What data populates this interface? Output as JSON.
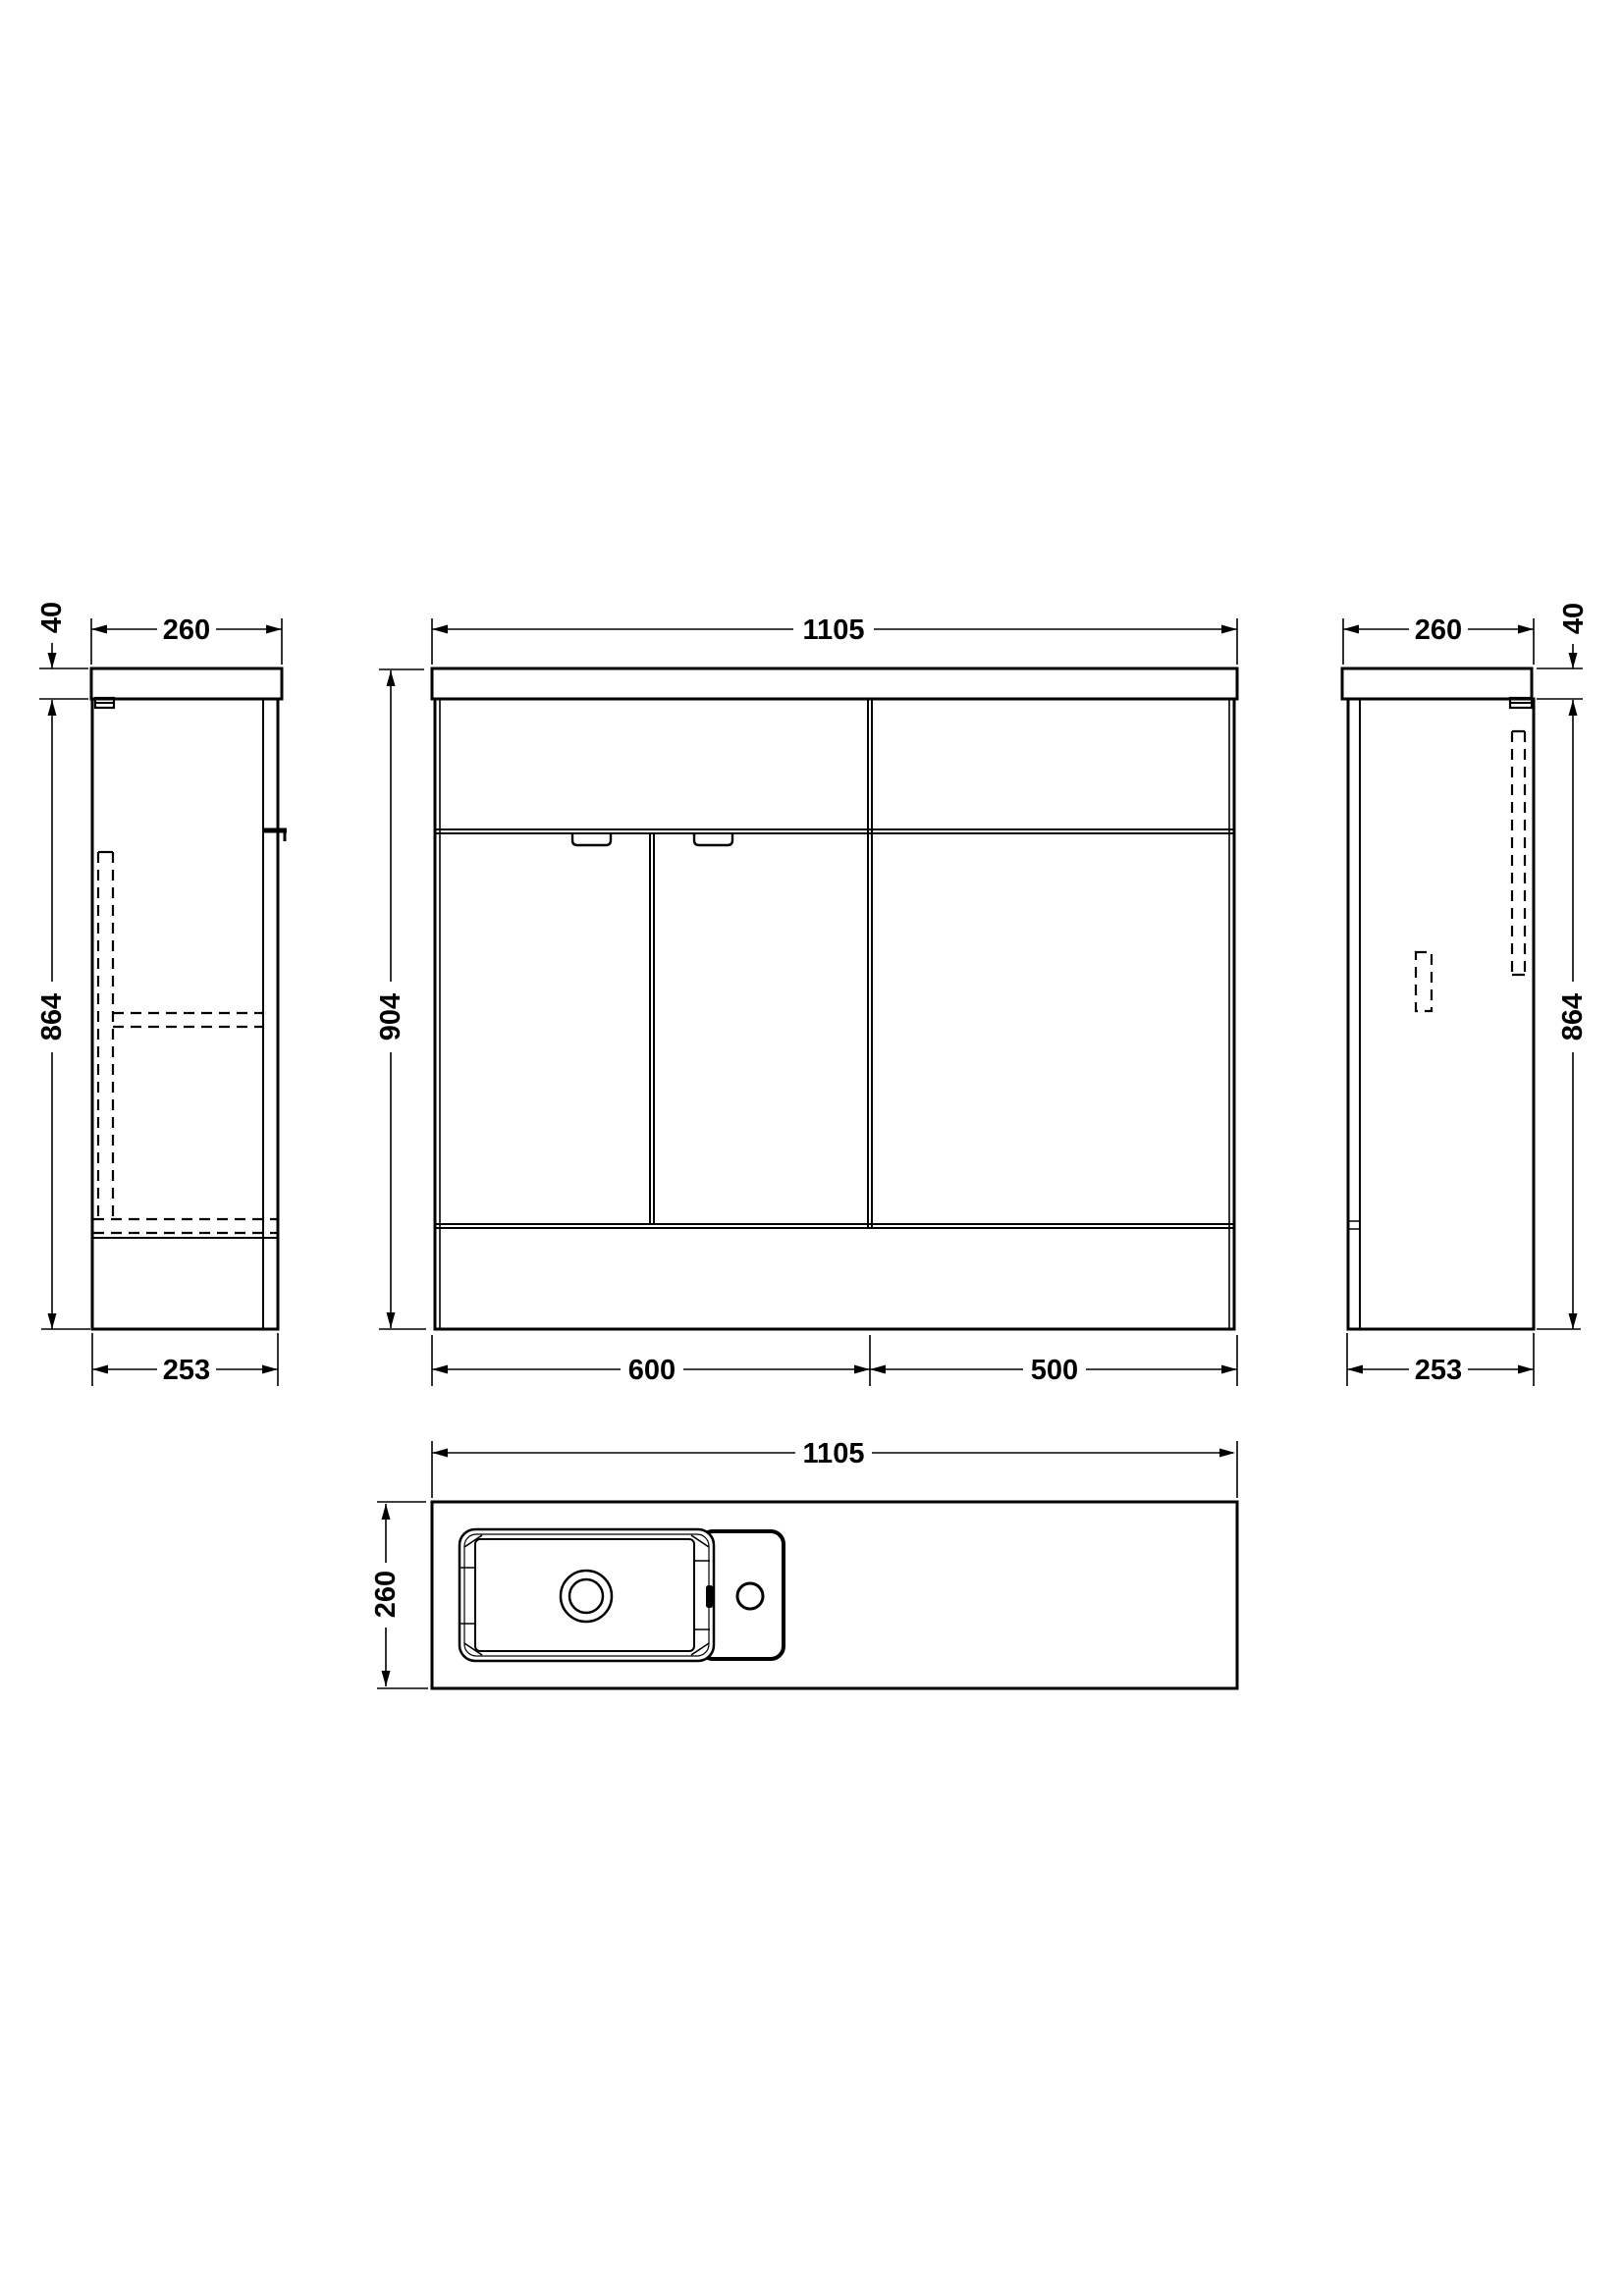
{
  "drawing": {
    "type": "furniture technical drawing",
    "background": "#ffffff",
    "line_color": "#000000",
    "views": {
      "left_side": {
        "dims": {
          "width_top": "260",
          "worktop_thickness": "40",
          "carcass_height": "864",
          "depth_bottom": "253"
        }
      },
      "front": {
        "dims": {
          "overall_width": "1105",
          "overall_height": "904",
          "vanity_section_width": "600",
          "wc_section_width": "500"
        }
      },
      "right_side": {
        "dims": {
          "width_top": "260",
          "worktop_thickness": "40",
          "carcass_height": "864",
          "depth_bottom": "253"
        }
      },
      "plan": {
        "dims": {
          "overall_width": "1105",
          "overall_depth": "260"
        }
      }
    }
  }
}
